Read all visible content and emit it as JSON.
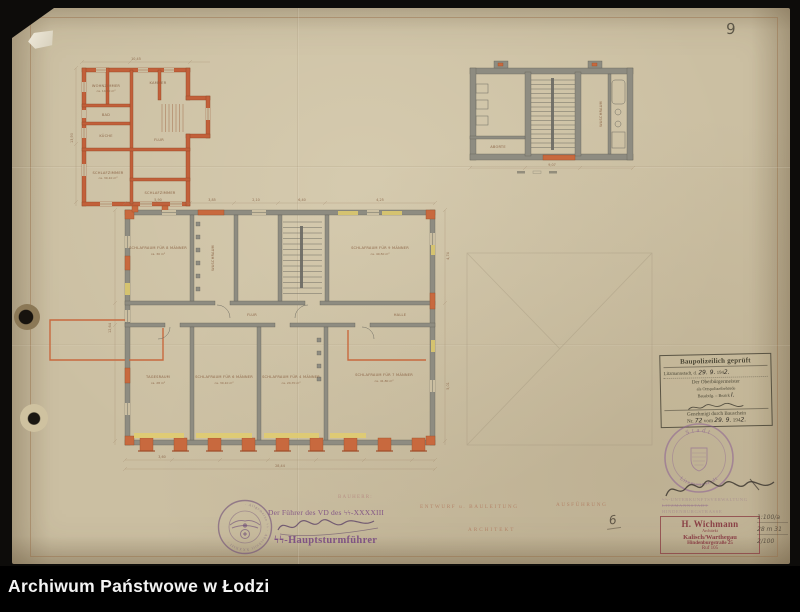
{
  "archive_bar": {
    "title": "Archiwum Państwowe w Łodzi"
  },
  "page_number": "9",
  "form_labels": {
    "client": "BAUHERR:",
    "design": "ENTWURF u. BAULEITUNG",
    "execution": "AUSFÜHRUNG",
    "architect": "ARCHITEKT"
  },
  "ss_endorsement": {
    "seal_ring": "· Allgemeine ϟϟ · Abschnitt XXXXIII ·",
    "line1": "Der Führer des VD des ϟϟ-XXXXIII",
    "rank": "ϟϟ-Hauptsturmführer"
  },
  "approval_stamp": {
    "title": "Baupolizeilich geprüft",
    "place": "Litzmannstadt, d.",
    "date_hand": "29. 9.",
    "year_print": "194",
    "year_hand": "2.",
    "authority1": "Der Oberbürgermeister",
    "authority2": "als Ortspolizeibehörde",
    "dept": "Bauabtlg. – Bezirk",
    "dept_hand": "I.",
    "approved": "Genehmigt durch Bauschein",
    "nr_label": "Nr.",
    "nr_hand": "72",
    "vom_label": "vom",
    "vom_date": "29. 9.",
    "vom_year": "194",
    "vom_year_hand": "2."
  },
  "city_seal": {
    "top": "Stadt",
    "bottom": "Litzmannstadt"
  },
  "quarter_stamp": {
    "line1": "ϟϟ-Unterkunftsverwaltung",
    "line2": "Litzmannstadt",
    "line3": "Hindenburgstraße"
  },
  "architect_stamp": {
    "name": "H. Wichmann",
    "title": "Architekt",
    "city": "Kalisch/Warthegau",
    "street": "Hindenburgstraße 25",
    "phone": "Ruf 105"
  },
  "pencil_notes": {
    "six": "6",
    "n1": "1:100/a",
    "n2": "28 m 31",
    "n3": "2/100"
  },
  "plan_upper": {
    "rooms": [
      {
        "label": "WOHNZIMMER",
        "area": "ca. 14,60 m²"
      },
      {
        "label": "BAD",
        "area": ""
      },
      {
        "label": "KÜCHE",
        "area": ""
      },
      {
        "label": "SCHLAFZIMMER",
        "area": "ca. 30,10 m²"
      },
      {
        "label": "KAMMER",
        "area": ""
      },
      {
        "label": "FLUR",
        "area": ""
      },
      {
        "label": "SCHLAFZIMMER",
        "area": ""
      }
    ],
    "dims": [
      "10,45",
      "13,90"
    ]
  },
  "plan_stair": {
    "rooms": [
      {
        "label": "ABORTE"
      },
      {
        "label": "WASCHRAUM"
      }
    ],
    "dims": [
      "9,07"
    ]
  },
  "plan_main": {
    "rooms": [
      {
        "label": "SCHLAFRAUM FÜR 8 MÄNNER",
        "area": "ca. 30 m²"
      },
      {
        "label": "WASCHRAUM",
        "area": ""
      },
      {
        "label": "SCHLAFRAUM FÜR 9 MÄNNER",
        "area": "ca. 40,50 m²"
      },
      {
        "label": "TAGESRAUM",
        "area": "ca. 28 m²"
      },
      {
        "label": "SCHLAFRAUM FÜR 6 MÄNNER",
        "area": "ca. 30,10 m²"
      },
      {
        "label": "SCHLAFRAUM FÜR 4 MÄNNER",
        "area": "ca. 24,70 m²"
      },
      {
        "label": "SCHLAFRAUM FÜR 7 MÄNNER",
        "area": "ca. 41,80 m²"
      },
      {
        "label": "FLUR",
        "area": ""
      },
      {
        "label": "HALLE",
        "area": ""
      }
    ],
    "dims": [
      "5,90",
      "3,85",
      "2,10",
      "6,40",
      "4,25",
      "3,60",
      "28,44",
      "12,64",
      "4,74",
      "5,01"
    ]
  }
}
